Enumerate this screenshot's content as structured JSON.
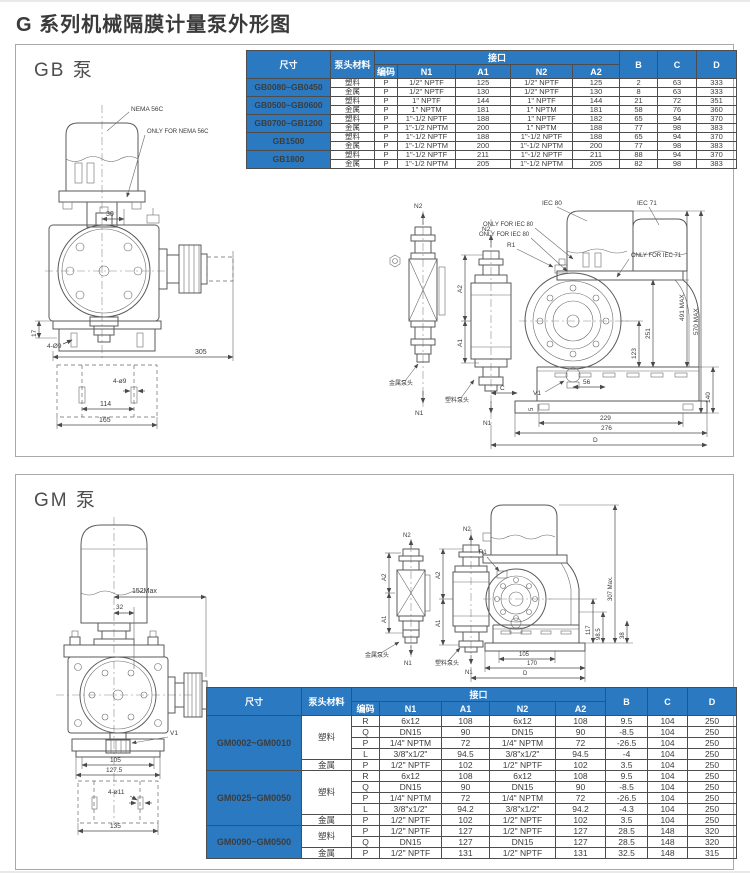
{
  "page": {
    "title": "G 系列机械隔膜计量泵外形图"
  },
  "colors": {
    "header_blue": "#2b7ac1",
    "line_gray": "#5a5a5a"
  },
  "headers": {
    "size": "尺寸",
    "material": "泵头材料",
    "interface": "接口",
    "code": "编码",
    "n1": "N1",
    "a1": "A1",
    "n2": "N2",
    "a2": "A2",
    "b": "B",
    "c": "C",
    "d": "D"
  },
  "gb": {
    "label": "GB 泵",
    "groups": [
      {
        "size": "GB0080~GB0450",
        "materials": [
          {
            "name": "塑料",
            "rows": [
              [
                "P",
                "1/2\" NPTF",
                "125",
                "1/2\" NPTF",
                "125",
                "2",
                "63",
                "333"
              ]
            ]
          },
          {
            "name": "金属",
            "rows": [
              [
                "P",
                "1/2\" NPTF",
                "130",
                "1/2\" NPTF",
                "130",
                "8",
                "63",
                "333"
              ]
            ]
          }
        ]
      },
      {
        "size": "GB0500~GB0600",
        "materials": [
          {
            "name": "塑料",
            "rows": [
              [
                "P",
                "1\" NPTF",
                "144",
                "1\" NPTF",
                "144",
                "21",
                "72",
                "351"
              ]
            ]
          },
          {
            "name": "金属",
            "rows": [
              [
                "P",
                "1\" NPTM",
                "181",
                "1\" NPTM",
                "181",
                "58",
                "76",
                "360"
              ]
            ]
          }
        ]
      },
      {
        "size": "GB0700~GB1200",
        "materials": [
          {
            "name": "塑料",
            "rows": [
              [
                "P",
                "1\"-1/2 NPTF",
                "188",
                "1\" NPTF",
                "182",
                "65",
                "94",
                "370"
              ]
            ]
          },
          {
            "name": "金属",
            "rows": [
              [
                "P",
                "1\"-1/2 NPTM",
                "200",
                "1\" NPTM",
                "188",
                "77",
                "98",
                "383"
              ]
            ]
          }
        ]
      },
      {
        "size": "GB1500",
        "materials": [
          {
            "name": "塑料",
            "rows": [
              [
                "P",
                "1\"-1/2 NPTF",
                "188",
                "1\"-1/2 NPTF",
                "188",
                "65",
                "94",
                "370"
              ]
            ]
          },
          {
            "name": "金属",
            "rows": [
              [
                "P",
                "1\"-1/2 NPTM",
                "200",
                "1\"-1/2 NPTM",
                "200",
                "77",
                "98",
                "383"
              ]
            ]
          }
        ]
      },
      {
        "size": "GB1800",
        "materials": [
          {
            "name": "塑料",
            "rows": [
              [
                "P",
                "1\"-1/2 NPTF",
                "211",
                "1\"-1/2 NPTF",
                "211",
                "88",
                "94",
                "370"
              ]
            ]
          },
          {
            "name": "金属",
            "rows": [
              [
                "P",
                "1\"-1/2 NPTM",
                "205",
                "1\"-1/2 NPTM",
                "205",
                "82",
                "98",
                "383"
              ]
            ]
          }
        ]
      }
    ],
    "front": {
      "nema": "NEMA 56C",
      "only_nema": "ONLY FOR NEMA 56C",
      "d30": "30",
      "d17": "17",
      "d4o9a": "4-Ø9",
      "d305": "305",
      "d4o9b": "4-ø9",
      "d114": "114",
      "d165": "165"
    },
    "side": {
      "iec80": "IEC 80",
      "iec71": "IEC 71",
      "only80a": "ONLY FOR IEC 80",
      "only80b": "ONLY FOR IEC 80",
      "only71": "ONLY FOR IEC 71",
      "n2s": "N2",
      "n1s": "N1",
      "n2m": "N2",
      "n1m": "N1",
      "a2m": "A2",
      "a1m": "A1",
      "r1": "R1",
      "v1": "V1",
      "dC": "C",
      "d5": "5",
      "metal": "金属泵头",
      "plastic": "塑料泵头",
      "d56": "56",
      "d123": "123",
      "d251": "251",
      "d491": "491 MAX.",
      "d570": "570 MAX.",
      "d140": "140",
      "d229": "229",
      "d276": "276",
      "dD": "D"
    }
  },
  "gm": {
    "label": "GM 泵",
    "groups": [
      {
        "size": "GM0002~GM0010",
        "materials": [
          {
            "name": "塑料",
            "rows": [
              [
                "R",
                "6x12",
                "108",
                "6x12",
                "108",
                "9.5",
                "104",
                "250"
              ],
              [
                "Q",
                "DN15",
                "90",
                "DN15",
                "90",
                "-8.5",
                "104",
                "250"
              ],
              [
                "P",
                "1/4\" NPTM",
                "72",
                "1/4\" NPTM",
                "72",
                "-26.5",
                "104",
                "250"
              ],
              [
                "L",
                "3/8\"x1/2\"",
                "94.5",
                "3/8\"x1/2\"",
                "94.5",
                "-4",
                "104",
                "250"
              ]
            ]
          },
          {
            "name": "金属",
            "rows": [
              [
                "P",
                "1/2\" NPTF",
                "102",
                "1/2\" NPTF",
                "102",
                "3.5",
                "104",
                "250"
              ]
            ]
          }
        ]
      },
      {
        "size": "GM0025~GM0050",
        "materials": [
          {
            "name": "塑料",
            "rows": [
              [
                "R",
                "6x12",
                "108",
                "6x12",
                "108",
                "9.5",
                "104",
                "250"
              ],
              [
                "Q",
                "DN15",
                "90",
                "DN15",
                "90",
                "-8.5",
                "104",
                "250"
              ],
              [
                "P",
                "1/4\" NPTM",
                "72",
                "1/4\" NPTM",
                "72",
                "-26.5",
                "104",
                "250"
              ],
              [
                "L",
                "3/8\"x1/2\"",
                "94.2",
                "3/8\"x1/2\"",
                "94.2",
                "-4.3",
                "104",
                "250"
              ]
            ]
          },
          {
            "name": "金属",
            "rows": [
              [
                "P",
                "1/2\" NPTF",
                "102",
                "1/2\" NPTF",
                "102",
                "3.5",
                "104",
                "250"
              ]
            ]
          }
        ]
      },
      {
        "size": "GM0090~GM0500",
        "materials": [
          {
            "name": "塑料",
            "rows": [
              [
                "P",
                "1/2\" NPTF",
                "127",
                "1/2\" NPTF",
                "127",
                "28.5",
                "148",
                "320"
              ],
              [
                "Q",
                "DN15",
                "127",
                "DN15",
                "127",
                "28.5",
                "148",
                "320"
              ]
            ]
          },
          {
            "name": "金属",
            "rows": [
              [
                "P",
                "1/2\" NPTF",
                "131",
                "1/2\" NPTF",
                "131",
                "32.5",
                "148",
                "315"
              ]
            ]
          }
        ]
      }
    ],
    "front": {
      "d152": "152Max",
      "d32": "32",
      "v1": "V1",
      "d105": "105",
      "d127_5": "127.5",
      "d4o11": "4-ø11",
      "d135": "135"
    },
    "side": {
      "n2s": "N2",
      "n1s": "N1",
      "n2m": "N2",
      "n1m": "N1",
      "a2s": "A2",
      "a1s": "A1",
      "a2m": "A2",
      "a1m": "A1",
      "r1": "R1",
      "metal": "金属泵头",
      "plastic": "塑料泵头",
      "d117": "117",
      "d98_5": "98.5",
      "d307": "307 Max.",
      "d38": "38",
      "d105b": "105",
      "d170": "170",
      "dD": "D"
    }
  }
}
